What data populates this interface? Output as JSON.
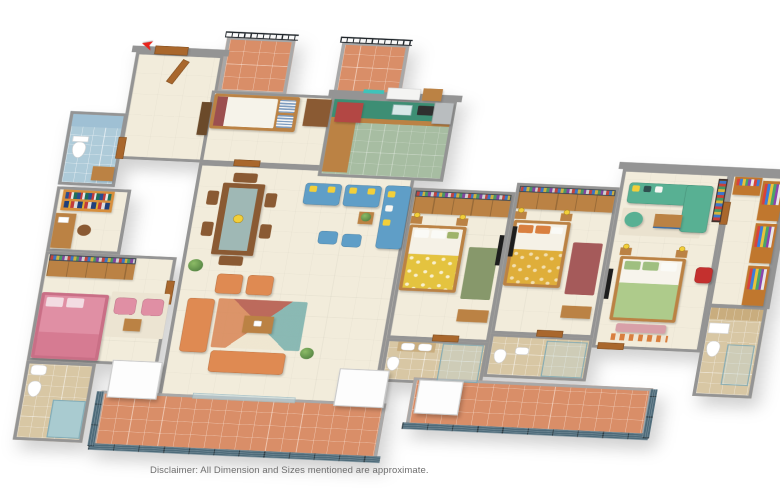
{
  "disclaimer": "Disclaimer: All Dimension and Sizes mentioned are approximate.",
  "entry": {
    "icon": "entry-arrow-icon",
    "glyph": "➤"
  },
  "palette": {
    "wall": "#949494",
    "floor": "#f2ecdb",
    "terracotta": "#d98e68",
    "rail": "#4e6b7a",
    "grille": "#20262b",
    "wood": "#bb8244",
    "wood_dark": "#8a5a33",
    "door_wood": "#a9672c",
    "counter_green": "#3d8e74",
    "cabinet_red": "#b34744",
    "sofa_blue": "#5f9ec7",
    "sofa_orange": "#df8a52",
    "sofa_teal": "#58b093",
    "bed_pink": "#e08fa4",
    "bed_green": "#aecb8b",
    "blanket_yellow": "#e4c33f",
    "blanket_mustard": "#dfae3a",
    "rug_green": "#87986b",
    "rug_maroon": "#a55a5a",
    "tile_blue": "#aecbd9",
    "tile_tan": "#d8c7a4",
    "stone": "#c9ad7e",
    "chair_red": "#c4302e",
    "pillow_yellow": "#f2cf3a",
    "appliance": "#b9bdbf",
    "closet_orange": "#c0772e",
    "white_box": "#fdfdfd",
    "text_grey": "#6e6e6e",
    "arrow_red": "#e8241c"
  }
}
